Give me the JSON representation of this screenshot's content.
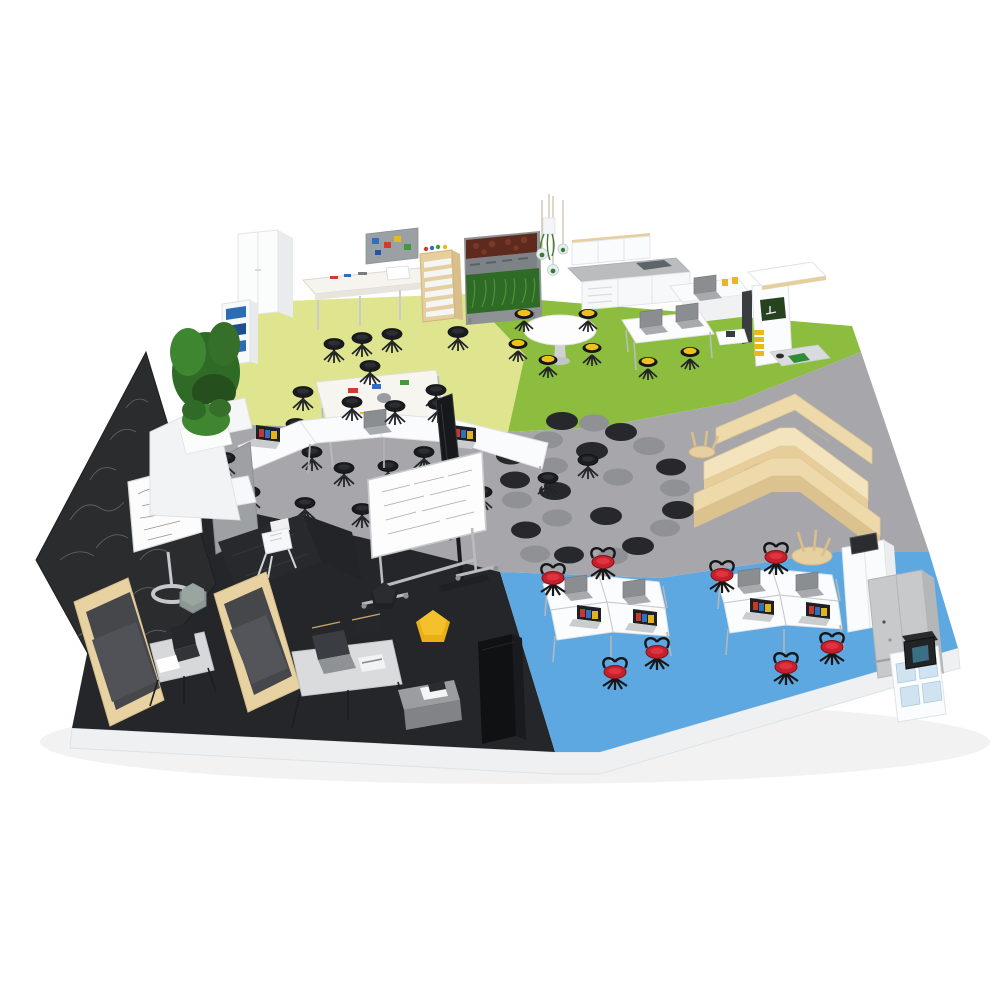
{
  "scene": {
    "description": "Isometric 3D render of a flexible learning space floor plan with five color-coded activity zones on a white plinth",
    "background": "#ffffff"
  },
  "palette": {
    "background": "#ffffff",
    "plinth": "#eef0f1",
    "floor_maker": "#dfe48f",
    "floor_science": "#8cbd3e",
    "floor_presentation": "#a7a7ab",
    "floor_lounge": "#242629",
    "floor_computer": "#5ea8e2",
    "chalkboard": "#2b2c2e",
    "wood_light": "#f4e4bd",
    "wood_mid": "#eed9ab",
    "wood_dark": "#dcc28e",
    "booth_wood": "#e8d2a2",
    "rug_dot_dark": "#26282c",
    "rug_dot_gray": "#8f9194",
    "seat_black": "#1b1c1f",
    "seat_yellow": "#efc11d",
    "seat_red": "#c6202c",
    "pouf_yellow": "#e9af14",
    "pouf_black": "#202124",
    "pouf_sage": "#8d9894",
    "plant_green": "#2f6b26",
    "plant_maroon": "#5e2a1e",
    "furniture_white": "#fafbfc",
    "table_gray": "#d9dbdc",
    "locker_gray": "#c7c9cb",
    "bin_blue": "#2d6cb3",
    "screen_dark": "#17181b"
  },
  "zones": [
    {
      "id": "maker",
      "label": "Maker / craft zone",
      "floor": "#dfe48f",
      "items": [
        "white wardrobe cabinet",
        "bookshelf with blue bins",
        "potted plant",
        "workbench with pegboard bins",
        "sewing machine",
        "tote-tray trolley",
        "craft table with supplies",
        "black swivel stools"
      ]
    },
    {
      "id": "science",
      "label": "Science / garden zone",
      "floor": "#8cbd3e",
      "items": [
        "living plant wall",
        "hanging glass planters",
        "wall cabinets",
        "kitchen counter with sink",
        "round cafe table with yellow stools",
        "lab desks with laptops",
        "mobile bench with microscopes",
        "demo station with yellow drawers"
      ]
    },
    {
      "id": "presentation",
      "label": "Presentation / collaboration zone",
      "floor": "#a7a7ab",
      "items": [
        "folding conference tables with laptops",
        "black swivel stools",
        "mobile whiteboard with equations",
        "display screen on stand",
        "polka-dot rug",
        "privacy panel",
        "white sled chair",
        "black benches",
        "wooden tiered seating"
      ]
    },
    {
      "id": "lounge",
      "label": "Lounge / quiet zone",
      "floor": "#242629",
      "items": [
        "chalkboard wall with chalk equations",
        "flip-chart stand",
        "high-back booth sofas",
        "laptop side table",
        "hexagon pouf",
        "black pentagon pouf",
        "yellow pentagon pouf",
        "gray work table with chairs",
        "ottoman with papers",
        "tall black cabinet"
      ]
    },
    {
      "id": "computer",
      "label": "Computer / media zone",
      "floor": "#5ea8e2",
      "items": [
        "two pinwheel desk clusters with laptops",
        "red swivel chairs",
        "tablet cabinet",
        "device charging locker",
        "storage cart with bins",
        "3D printer",
        "upturned wooden stools"
      ]
    }
  ],
  "counts": {
    "red_chairs": 8,
    "desk_clusters": 2,
    "rug_dark_dots": 12,
    "rug_gray_dots": 11
  }
}
